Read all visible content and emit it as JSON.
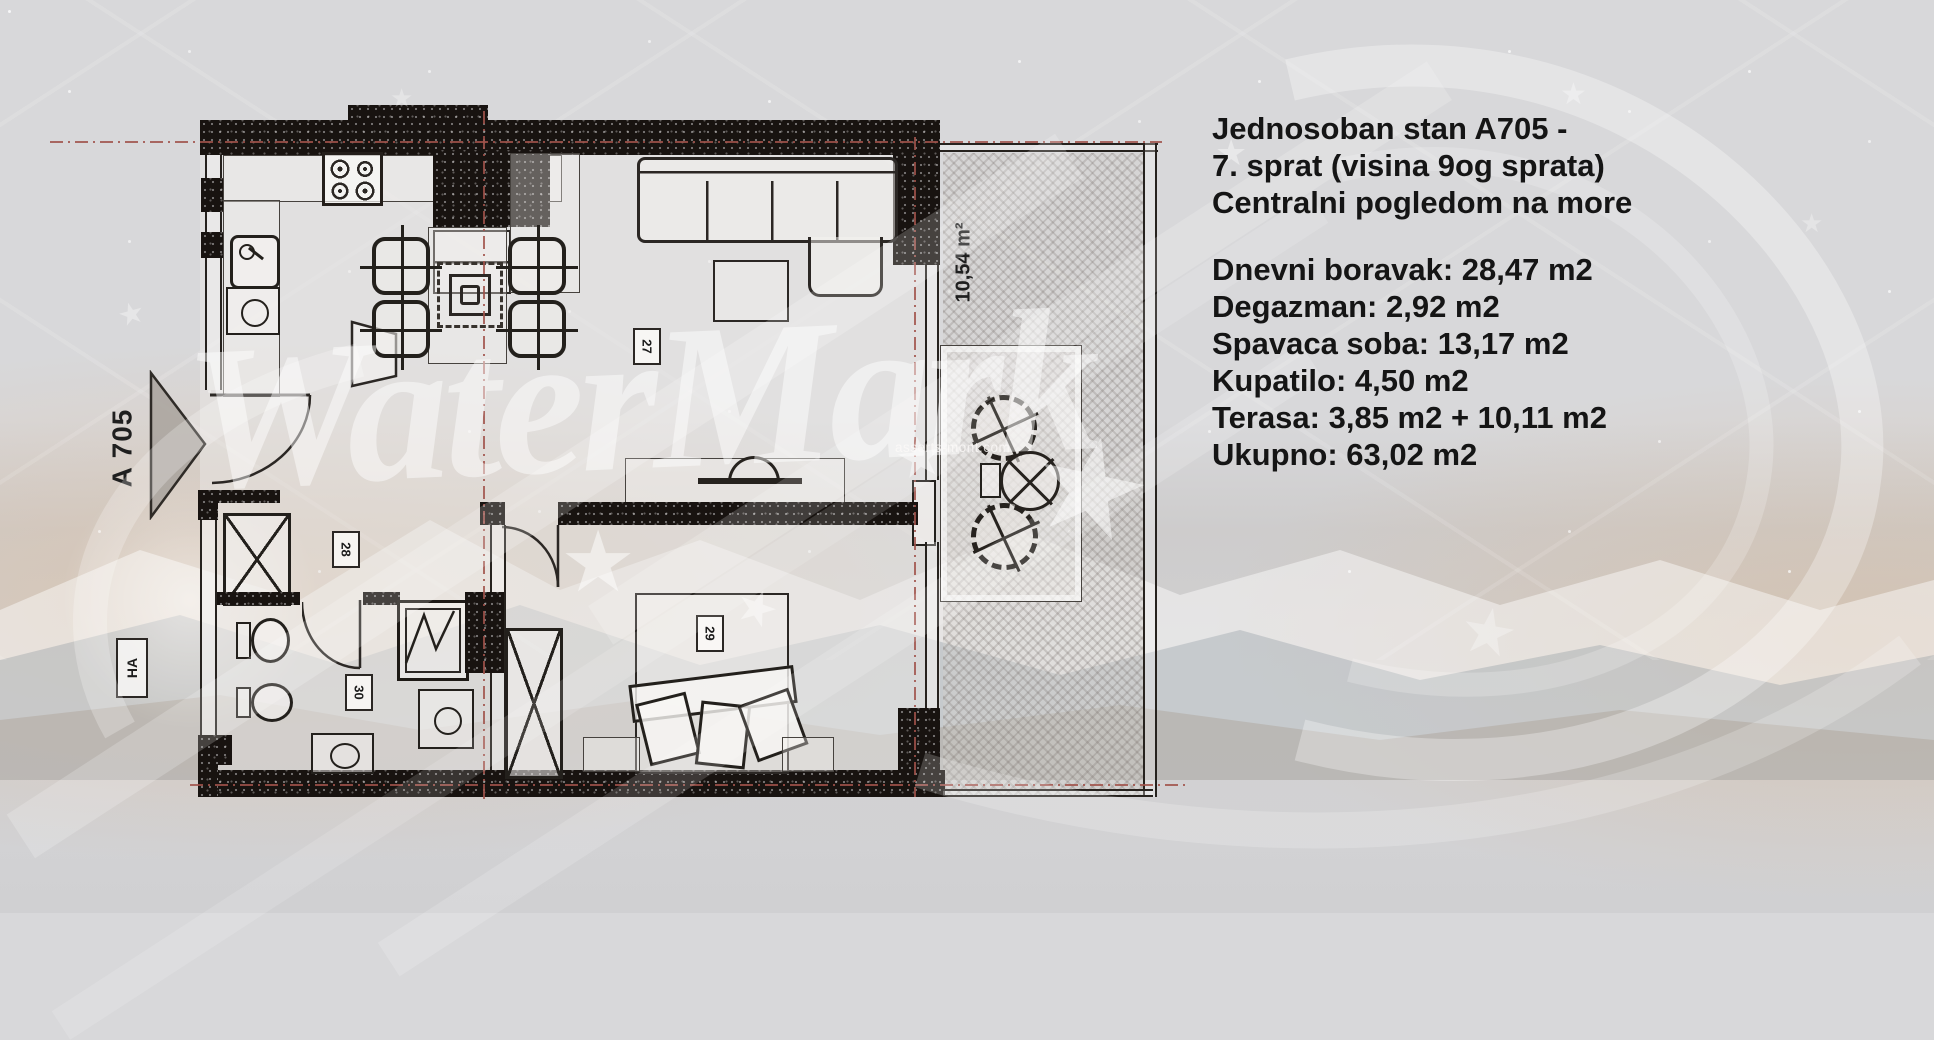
{
  "info_panel": {
    "title_lines": [
      "Jednosoban stan A705 -",
      "7. sprat (visina 9og sprata)",
      "Centralni pogledom na more"
    ],
    "area_lines": [
      "Dnevni boravak: 28,47 m2",
      "Degazman: 2,92 m2",
      "Spavaca soba: 13,17 m2",
      "Kupatilo: 4,50 m2",
      "Terasa: 3,85 m2 + 10,11 m2",
      "Ukupno: 63,02 m2"
    ]
  },
  "floor_plan": {
    "entrance_label": "A 705",
    "corridor_label": "HA",
    "terrace_area": "10,54 m²",
    "room_tags": {
      "living_room": "27",
      "hallway": "28",
      "bedroom": "29",
      "bathroom": "30"
    }
  },
  "watermark": {
    "brand": "WaterMark",
    "url": "asserts-mont.com",
    "star_glyph": "★"
  },
  "colors": {
    "background": "#d8d8da",
    "wall_dark": "#181310",
    "line_dark": "#2b2724",
    "axis_red": "#a0524a",
    "text": "#151515",
    "watermark_white": "rgba(255,255,255,0.47)"
  }
}
